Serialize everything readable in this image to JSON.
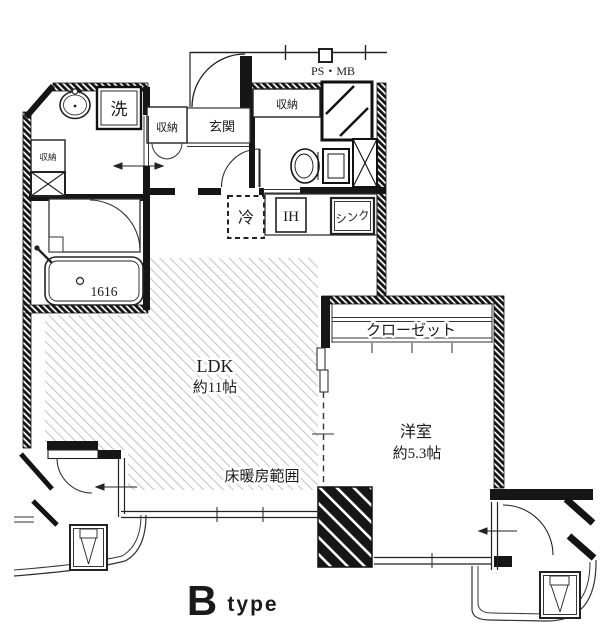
{
  "floorplan": {
    "unit_type": {
      "letter": "B",
      "word": "type"
    },
    "service": {
      "ps_mb": "PS・MB"
    },
    "entrance": {
      "label": "玄関",
      "storage_left": "収納",
      "storage_right": "収納"
    },
    "washroom": {
      "washer": "洗",
      "storage": "収納"
    },
    "bath": {
      "tub_size": "1616"
    },
    "kitchen": {
      "fridge": "冷",
      "cooktop": "IH",
      "sink": "シンク"
    },
    "ldk": {
      "name": "LDK",
      "area": "約11帖",
      "floor_heating_note": "床暖房範囲"
    },
    "western_room": {
      "name": "洋室",
      "area": "約5.3帖",
      "closet": "クローゼット"
    }
  }
}
